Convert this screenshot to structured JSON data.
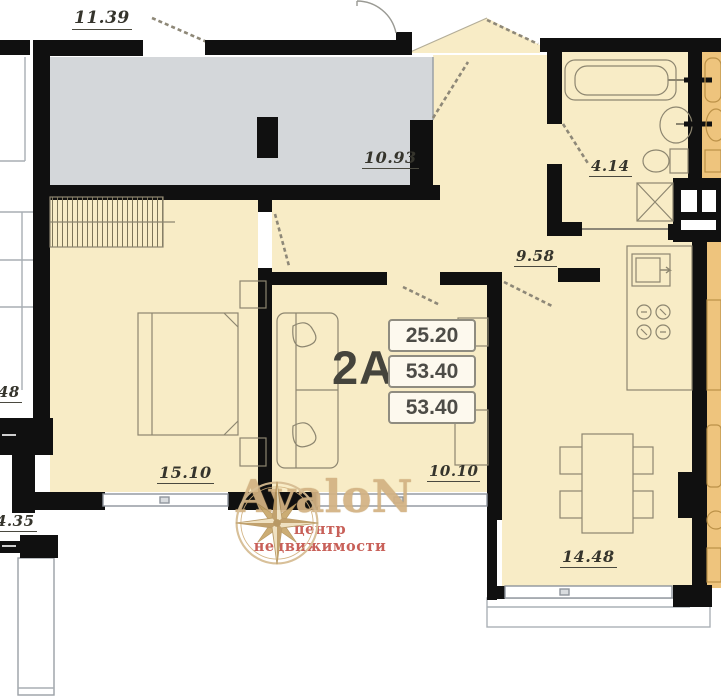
{
  "plan": {
    "unit_label": "2A",
    "area_box": {
      "values": [
        "25.20",
        "53.40",
        "53.40"
      ]
    },
    "dimensions": {
      "top_balcony": "11.39",
      "loggia": "10.93",
      "bathroom": "4.14",
      "hallway": "9.58",
      "bedroom": "15.10",
      "living": "10.10",
      "kitchen": "14.48",
      "left_upper": "48",
      "left_lower": "4.35"
    }
  },
  "watermark": {
    "brand": "AvaloN",
    "tagline": "центр недвижимости"
  },
  "colors": {
    "room_cream": "#f8ecc6",
    "loggia_gray": "#d4d7da",
    "neighbor_orange": "#eec47d",
    "wall_black": "#101010",
    "watermark_gold": "#d3b283",
    "watermark_red": "#c4554d"
  }
}
